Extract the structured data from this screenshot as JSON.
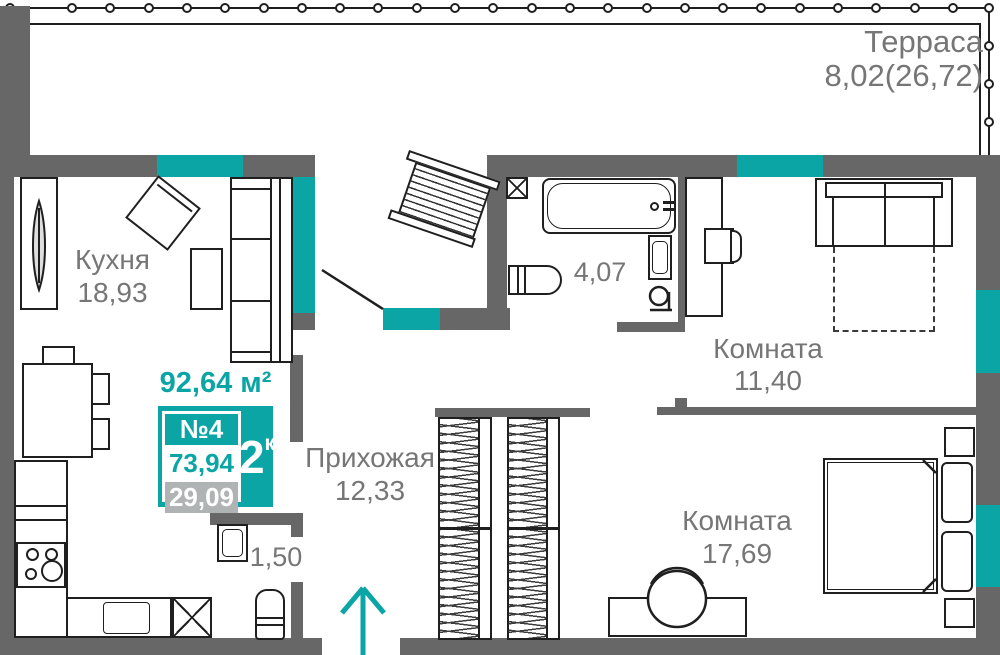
{
  "colors": {
    "accent": "#0ba5a6",
    "wall": "#666766",
    "text": "#767676",
    "line": "#1f1f1f",
    "muted": "#b0b3b3"
  },
  "header": {
    "total_area": "92,64 м²"
  },
  "unit_card": {
    "number": "№4",
    "type_value": "2",
    "type_sup": "к",
    "area_main": "73,94",
    "area_secondary": "29,09"
  },
  "labels": {
    "terrace": {
      "name": "Терраса",
      "area": "8,02(26,72)"
    },
    "kitchen": {
      "name": "Кухня",
      "area": "18,93"
    },
    "bathroom": {
      "area": "4,07"
    },
    "room_top": {
      "name": "Комната",
      "area": "11,40"
    },
    "hallway": {
      "name": "Прихожая",
      "area": "12,33"
    },
    "room_bottom": {
      "name": "Комната",
      "area": "17,69"
    },
    "wc": {
      "area": "1,50"
    }
  }
}
